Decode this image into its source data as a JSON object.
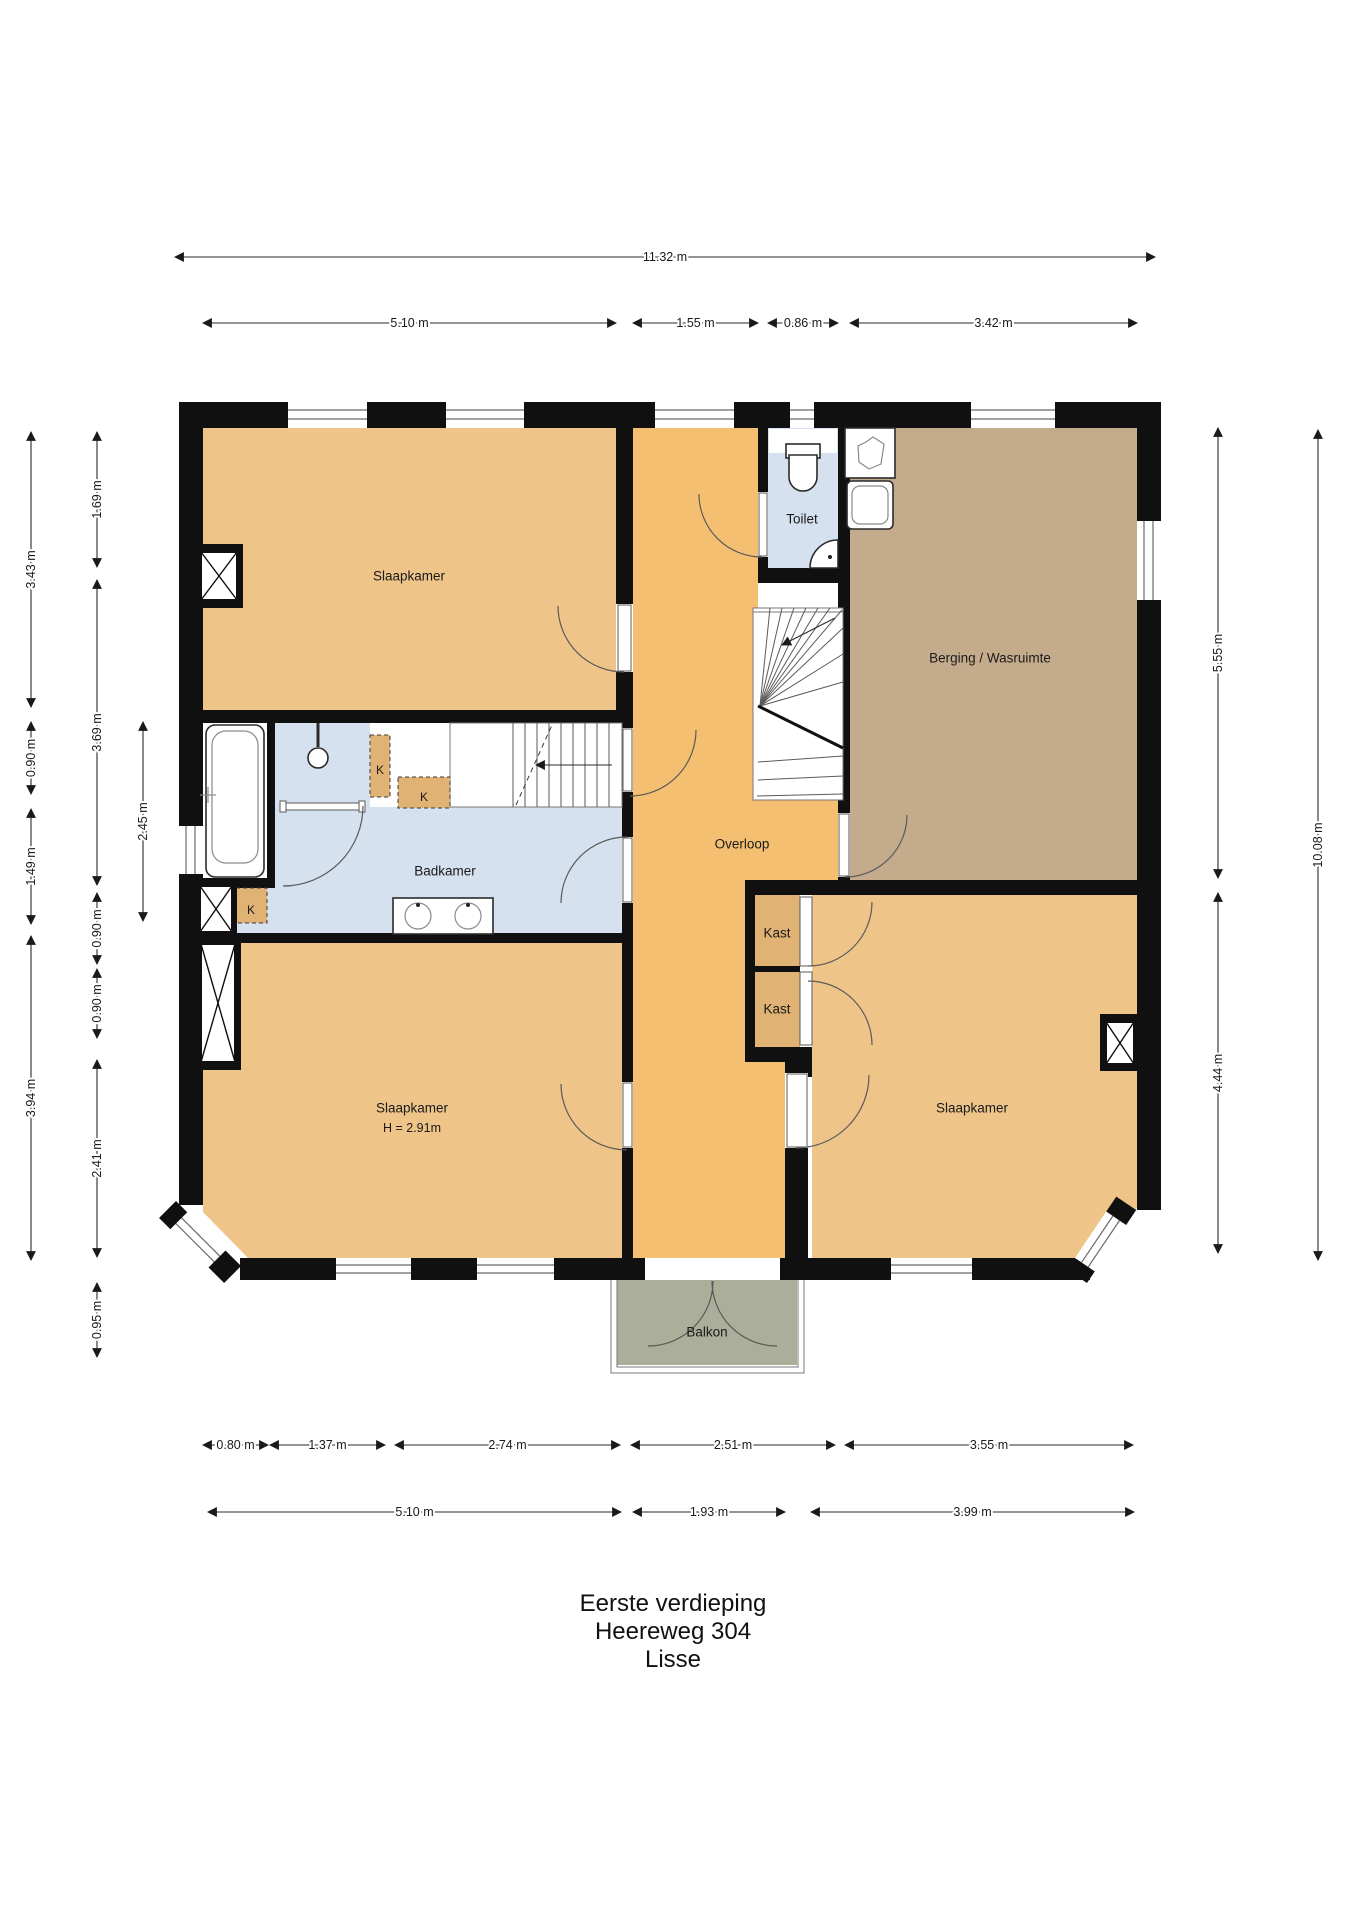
{
  "title": {
    "line1": "Eerste verdieping",
    "line2": "Heereweg 304",
    "line3": "Lisse"
  },
  "colors": {
    "wall": "#101010",
    "bedroom": "#eec489",
    "hallway": "#f5bf72",
    "closet": "#e0b274",
    "storage": "#c3ab8c",
    "bathroom": "#d5e1ee",
    "balcony": "#abae99",
    "dim_text": "#1a1a1a"
  },
  "rooms": [
    {
      "id": "bedroom-top-left",
      "label": "Slaapkamer",
      "x": 409,
      "y": 576
    },
    {
      "id": "toilet",
      "label": "Toilet",
      "x": 802,
      "y": 519
    },
    {
      "id": "storage-laundry",
      "label": "Berging / Wasruimte",
      "x": 990,
      "y": 658
    },
    {
      "id": "landing",
      "label": "Overloop",
      "x": 742,
      "y": 844
    },
    {
      "id": "bathroom",
      "label": "Badkamer",
      "x": 445,
      "y": 871
    },
    {
      "id": "closet-1",
      "label": "Kast",
      "x": 777,
      "y": 933
    },
    {
      "id": "closet-2",
      "label": "Kast",
      "x": 777,
      "y": 1009
    },
    {
      "id": "bedroom-bottom-left",
      "label": "Slaapkamer",
      "sublabel": "H = 2.91m",
      "x": 412,
      "y": 1108
    },
    {
      "id": "bedroom-right",
      "label": "Slaapkamer",
      "x": 972,
      "y": 1108
    },
    {
      "id": "balcony",
      "label": "Balkon",
      "x": 707,
      "y": 1332
    }
  ],
  "closet_marks": [
    {
      "label": "K",
      "x": 380,
      "y": 770
    },
    {
      "label": "K",
      "x": 424,
      "y": 797
    },
    {
      "label": "K",
      "x": 251,
      "y": 910
    }
  ],
  "dimensions": {
    "horizontal": [
      {
        "label": "11.32 m",
        "x1": 175,
        "x2": 1155,
        "y": 257
      },
      {
        "label": "5.10 m",
        "x1": 203,
        "x2": 616,
        "y": 323
      },
      {
        "label": "1.55 m",
        "x1": 633,
        "x2": 758,
        "y": 323
      },
      {
        "label": "0.86 m",
        "x1": 768,
        "x2": 838,
        "y": 323
      },
      {
        "label": "3.42 m",
        "x1": 850,
        "x2": 1137,
        "y": 323
      },
      {
        "label": "0.80 m",
        "x1": 203,
        "x2": 268,
        "y": 1445
      },
      {
        "label": "1.37 m",
        "x1": 270,
        "x2": 385,
        "y": 1445
      },
      {
        "label": "2.74 m",
        "x1": 395,
        "x2": 620,
        "y": 1445
      },
      {
        "label": "2.51 m",
        "x1": 631,
        "x2": 835,
        "y": 1445
      },
      {
        "label": "3.55 m",
        "x1": 845,
        "x2": 1133,
        "y": 1445
      },
      {
        "label": "5.10 m",
        "x1": 208,
        "x2": 621,
        "y": 1512
      },
      {
        "label": "1.93 m",
        "x1": 633,
        "x2": 785,
        "y": 1512
      },
      {
        "label": "3.99 m",
        "x1": 811,
        "x2": 1134,
        "y": 1512
      }
    ],
    "vertical": [
      {
        "label": "3.43 m",
        "x": 31,
        "y1": 432,
        "y2": 707
      },
      {
        "label": "0.90 m",
        "x": 31,
        "y1": 722,
        "y2": 794
      },
      {
        "label": "1.49 m",
        "x": 31,
        "y1": 809,
        "y2": 924
      },
      {
        "label": "3.94 m",
        "x": 31,
        "y1": 936,
        "y2": 1260
      },
      {
        "label": "1.69 m",
        "x": 97,
        "y1": 432,
        "y2": 567
      },
      {
        "label": "3.69 m",
        "x": 97,
        "y1": 580,
        "y2": 885
      },
      {
        "label": "0.90 m",
        "x": 97,
        "y1": 893,
        "y2": 964
      },
      {
        "label": "0.90 m",
        "x": 97,
        "y1": 969,
        "y2": 1038
      },
      {
        "label": "2.41 m",
        "x": 97,
        "y1": 1060,
        "y2": 1257
      },
      {
        "label": "0.95 m",
        "x": 97,
        "y1": 1283,
        "y2": 1357
      },
      {
        "label": "2.45 m",
        "x": 143,
        "y1": 722,
        "y2": 921
      },
      {
        "label": "5.55 m",
        "x": 1218,
        "y1": 428,
        "y2": 878
      },
      {
        "label": "4.44 m",
        "x": 1218,
        "y1": 893,
        "y2": 1253
      },
      {
        "label": "10.08 m",
        "x": 1318,
        "y1": 430,
        "y2": 1260
      }
    ]
  },
  "fixtures": [
    "toilet",
    "corner-washbasin",
    "bathtub",
    "shower-head",
    "double-washbasin",
    "laundry-sink",
    "washing-machine",
    "winder-staircase",
    "staircase",
    "chimney-shaft",
    "balcony-railing"
  ]
}
